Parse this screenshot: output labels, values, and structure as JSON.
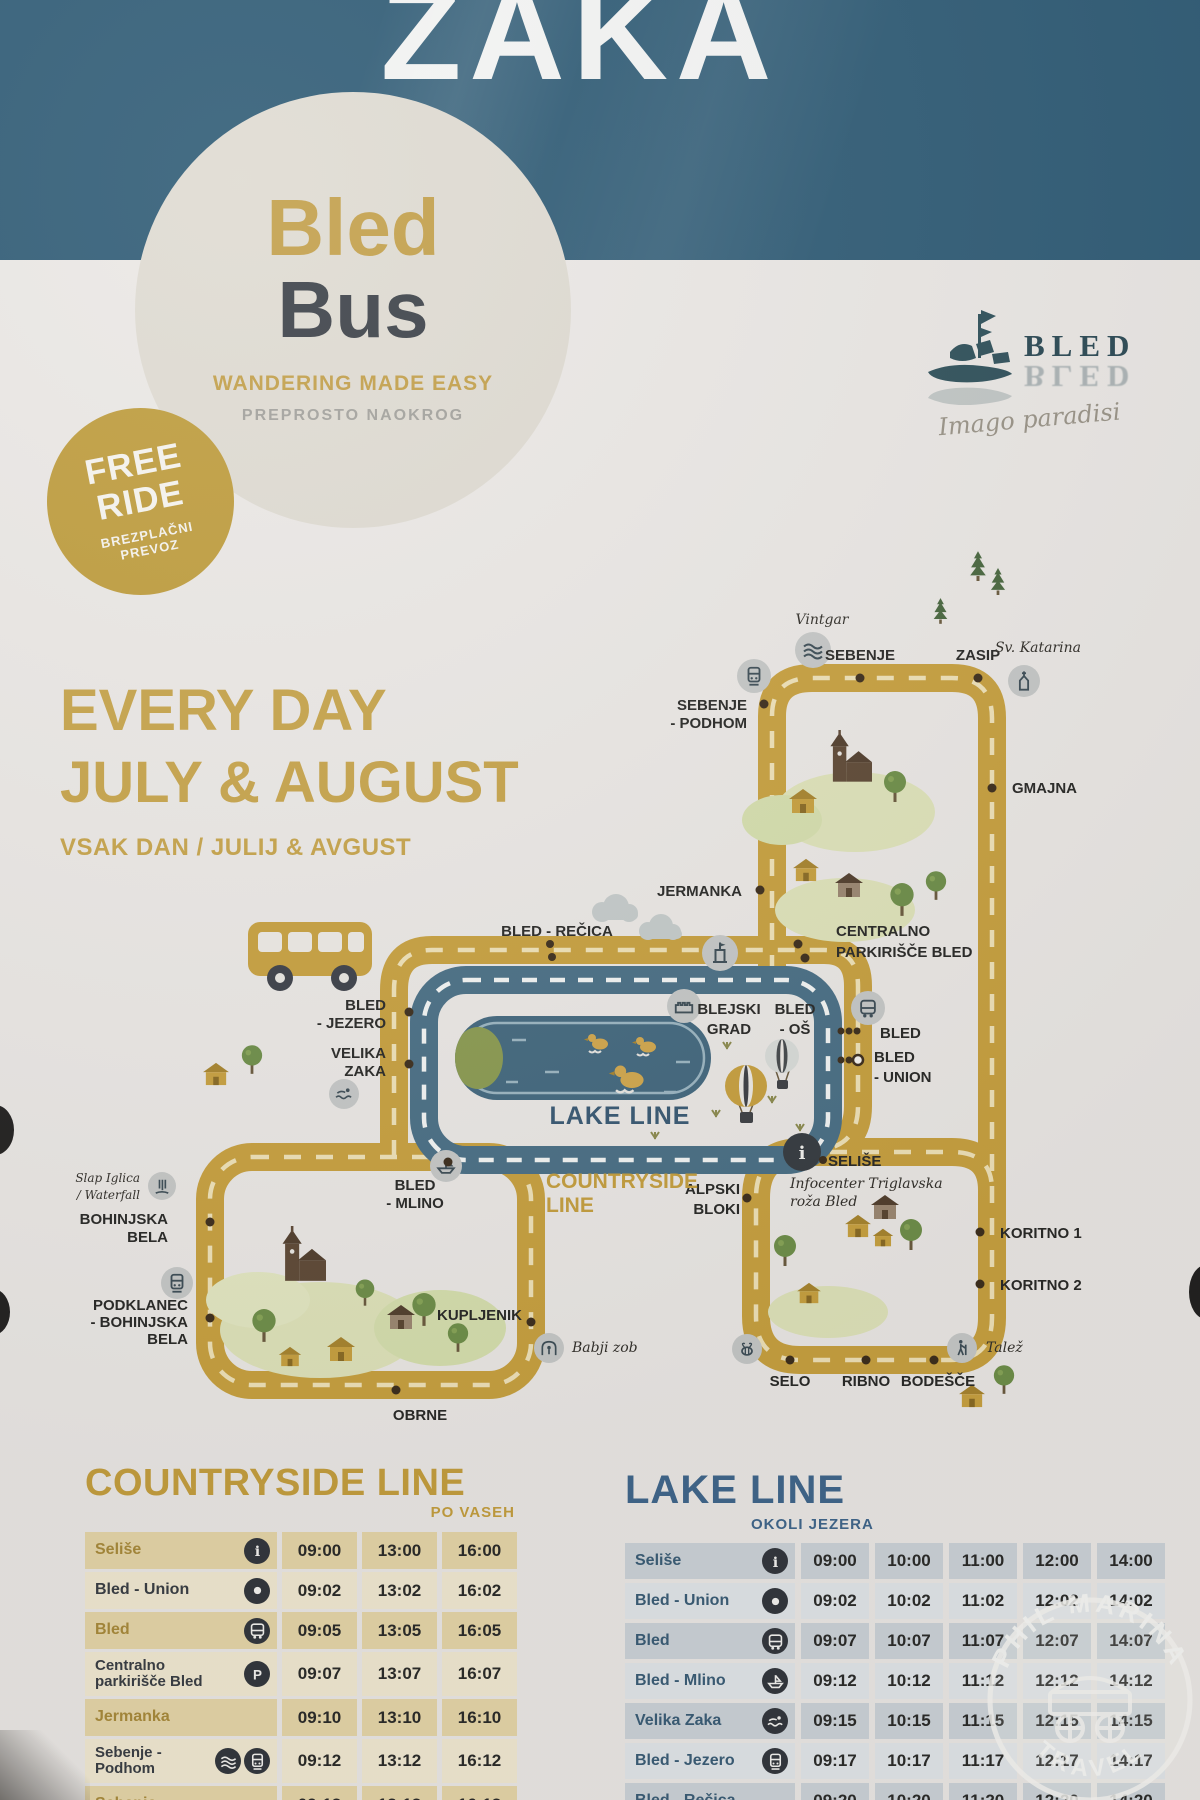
{
  "banner": {
    "title": "ZAKA"
  },
  "logo_circle": {
    "brand_top": "Bled",
    "brand_bottom": "Bus",
    "tagline": "WANDERING MADE EASY",
    "tagline_sl": "PREPROSTO NAOKROG"
  },
  "free_badge": {
    "l1": "FREE",
    "l2": "RIDE",
    "s1": "BREZPLAČNI",
    "s2": "PREVOZ"
  },
  "bled_logo": {
    "wordmark": "BLED",
    "wordmark_reflection": "BLED",
    "script": "Imago paradisi"
  },
  "headline": {
    "l1": "EVERY DAY",
    "l2": "JULY & AUGUST",
    "sub": "VSAK DAN / JULIJ & AVGUST"
  },
  "colors": {
    "banner_teal": "#305c76",
    "gold": "#c8a140",
    "lake_blue": "#4b7086",
    "paper": "#ebe8e5",
    "countryside_accent": "#c59f3f",
    "lake_accent": "#41678c"
  },
  "map": {
    "lake_line_label": "LAKE LINE",
    "countryside_l1": "COUNTRYSIDE",
    "countryside_l2": "LINE",
    "stops": {
      "vintgar": "Vintgar",
      "sebenje": "SEBENJE",
      "zasip": "ZASIP",
      "sv_katarina": "Sv. Katarina",
      "sebenje_podhom_l1": "SEBENJE",
      "sebenje_podhom_l2": "- PODHOM",
      "gmajna": "GMAJNA",
      "jermanka": "JERMANKA",
      "centralno_l1": "CENTRALNO",
      "centralno_l2": "PARKIRIŠČE BLED",
      "bled_recica": "BLED - REČICA",
      "bled_jezero_l1": "BLED",
      "bled_jezero_l2": "- JEZERO",
      "velika_zaka_l1": "VELIKA",
      "velika_zaka_l2": "ZAKA",
      "blejski_grad_l1": "BLEJSKI",
      "blejski_grad_l2": "GRAD",
      "bled_os_l1": "BLED",
      "bled_os_l2": "- OŠ",
      "bled": "BLED",
      "bled_union_l1": "BLED",
      "bled_union_l2": "- UNION",
      "selise": "SELIŠE",
      "infocenter_l1": "Infocenter Triglavska",
      "infocenter_l2": "roža Bled",
      "alpski_l1": "ALPSKI",
      "alpski_l2": "BLOKI",
      "koritno1": "KORITNO 1",
      "koritno2": "KORITNO 2",
      "slap_l1": "Slap Iglica",
      "slap_l2": "/ Waterfall",
      "bohinjska_l1": "BOHINJSKA",
      "bohinjska_l2": "BELA",
      "podklanec_l1": "PODKLANEC",
      "podklanec_l2": "- BOHINJSKA",
      "podklanec_l3": "BELA",
      "bled_mlino_l1": "BLED",
      "bled_mlino_l2": "- MLINO",
      "kupljenik": "KUPLJENIK",
      "babji_zob": "Babji zob",
      "selo": "SELO",
      "ribno": "RIBNO",
      "bodesce": "BODEŠČE",
      "talez": "Talež",
      "obrne": "OBRNE"
    }
  },
  "tables": {
    "countryside": {
      "title": "COUNTRYSIDE LINE",
      "subtitle": "PO VASEH",
      "rows": [
        {
          "stop": "Seliše",
          "icons": [
            "info"
          ],
          "times": [
            "09:00",
            "13:00",
            "16:00"
          ]
        },
        {
          "stop": "Bled - Union",
          "icons": [
            "target"
          ],
          "times": [
            "09:02",
            "13:02",
            "16:02"
          ]
        },
        {
          "stop": "Bled",
          "icons": [
            "bus"
          ],
          "times": [
            "09:05",
            "13:05",
            "16:05"
          ]
        },
        {
          "stop": "Centralno parkirišče Bled",
          "icons": [
            "parking"
          ],
          "times": [
            "09:07",
            "13:07",
            "16:07"
          ]
        },
        {
          "stop": "Jermanka",
          "icons": [],
          "times": [
            "09:10",
            "13:10",
            "16:10"
          ]
        },
        {
          "stop": "Sebenje - Podhom",
          "icons": [
            "gorge",
            "train"
          ],
          "times": [
            "09:12",
            "13:12",
            "16:12"
          ]
        },
        {
          "stop": "Sebenje",
          "icons": [],
          "times": [
            "09:13",
            "13:13",
            "16:13"
          ]
        }
      ]
    },
    "lake": {
      "title": "LAKE LINE",
      "subtitle": "OKOLI JEZERA",
      "rows": [
        {
          "stop": "Seliše",
          "icons": [
            "info"
          ],
          "times": [
            "09:00",
            "10:00",
            "11:00",
            "12:00",
            "14:00"
          ]
        },
        {
          "stop": "Bled - Union",
          "icons": [
            "target"
          ],
          "times": [
            "09:02",
            "10:02",
            "11:02",
            "12:02",
            "14:02"
          ]
        },
        {
          "stop": "Bled",
          "icons": [
            "bus"
          ],
          "times": [
            "09:07",
            "10:07",
            "11:07",
            "12:07",
            "14:07"
          ]
        },
        {
          "stop": "Bled - Mlino",
          "icons": [
            "boat"
          ],
          "times": [
            "09:12",
            "10:12",
            "11:12",
            "12:12",
            "14:12"
          ]
        },
        {
          "stop": "Velika Zaka",
          "icons": [
            "swimmer"
          ],
          "times": [
            "09:15",
            "10:15",
            "11:15",
            "12:15",
            "14:15"
          ]
        },
        {
          "stop": "Bled - Jezero",
          "icons": [
            "train"
          ],
          "times": [
            "09:17",
            "10:17",
            "11:17",
            "12:17",
            "14:17"
          ]
        },
        {
          "stop": "Bled - Rečica",
          "icons": [],
          "times": [
            "09:20",
            "10:20",
            "11:20",
            "12:20",
            "14:20"
          ]
        }
      ]
    }
  },
  "watermark": {
    "arc_top": "PHIL MARINA",
    "arc_bottom": "TRAVEL"
  }
}
